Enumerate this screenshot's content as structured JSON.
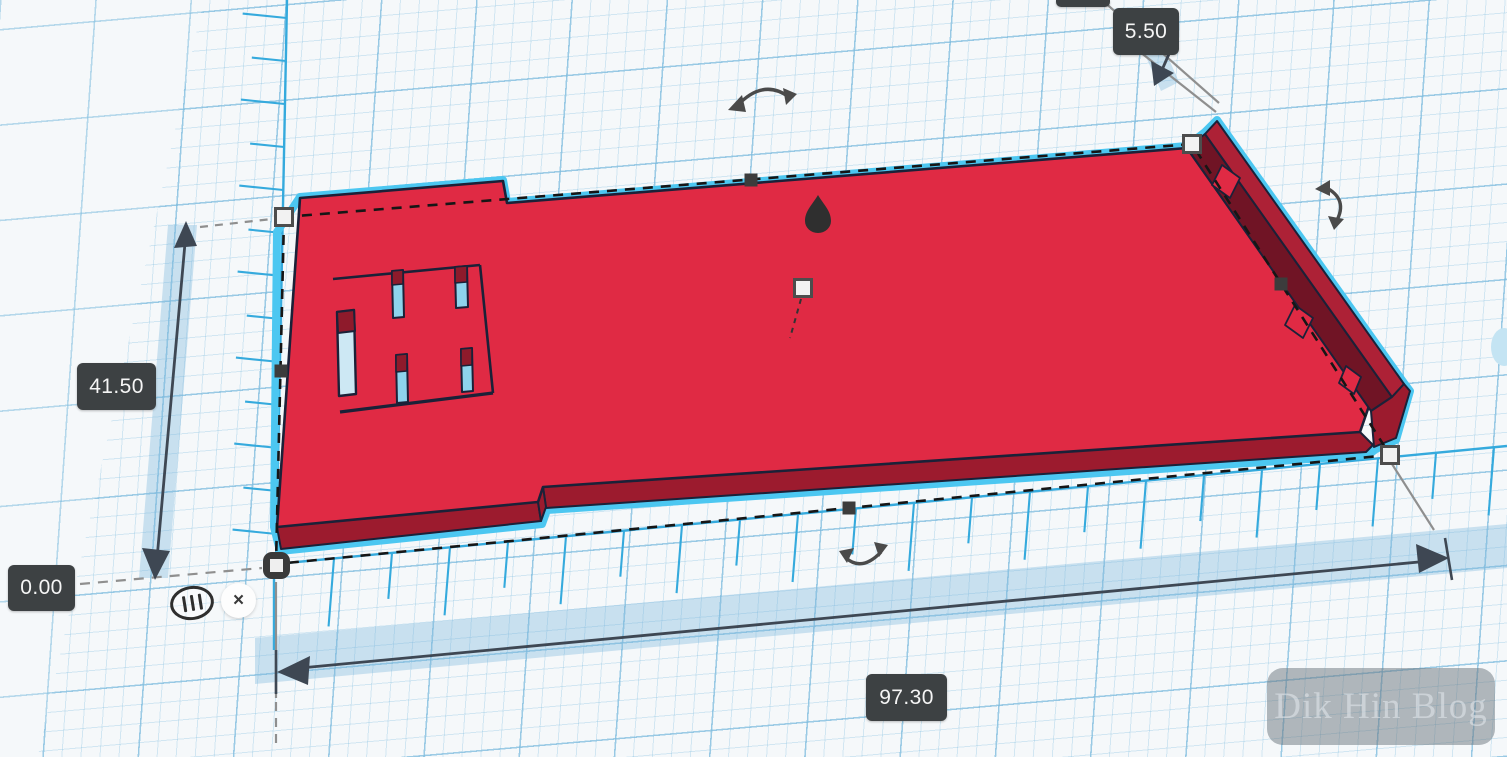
{
  "workspace": {
    "type": "3d-cad-design-canvas",
    "selected_object": "red flat base plate with slots and end rail",
    "tool_active": "ruler measurement"
  },
  "dimension_labels": {
    "depth": "41.50",
    "elevation": "0.00",
    "rail_height": "5.50",
    "width": "97.30"
  },
  "ruler_widget": {
    "close_label": "×",
    "icon": "ruler-stripes-icon"
  },
  "watermark": {
    "text": "Dik Hin Blog"
  },
  "icons": [
    "ruler-stripes-icon",
    "close-icon",
    "rotate-arrow-icon",
    "scale-corner-handle",
    "scale-edge-handle",
    "move-z-cone-handle",
    "workplane-anchor-handle",
    "center-handle"
  ],
  "colors": {
    "shape_top": "#e02a44",
    "shape_side": "#9c1b2e",
    "rail_top": "#ad2136",
    "rail_inner": "#701425",
    "outline": "#1b2138",
    "selection_glow": "#4cc7f1",
    "ruler_blue": "#35aadd",
    "grid_blue": "#a9cfe3",
    "label_bg": "#3d4143",
    "label_text": "#f5f5f5",
    "dimension_line": "#3e4753"
  }
}
